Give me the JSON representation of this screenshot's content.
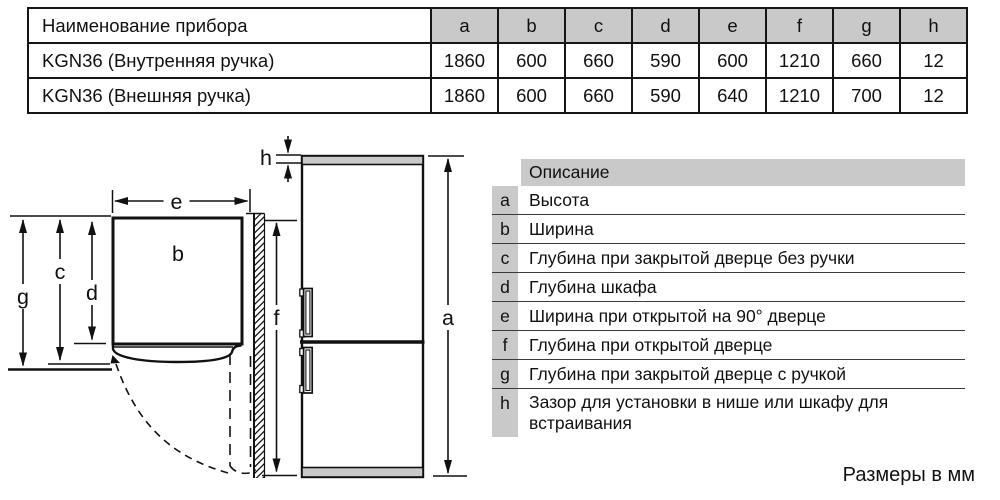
{
  "page": {
    "footer_note": "Размеры в мм"
  },
  "colors": {
    "header_gray": "#c9c9c9",
    "line": "#111111",
    "background": "#ffffff"
  },
  "spec_table": {
    "name_header": "Наименование прибора",
    "dim_headers": [
      "a",
      "b",
      "c",
      "d",
      "e",
      "f",
      "g",
      "h"
    ],
    "rows": [
      {
        "name": "KGN36 (Внутренняя ручка)",
        "values": [
          "1860",
          "600",
          "660",
          "590",
          "600",
          "1210",
          "660",
          "12"
        ]
      },
      {
        "name": "KGN36 (Внешняя ручка)",
        "values": [
          "1860",
          "600",
          "660",
          "590",
          "640",
          "1210",
          "700",
          "12"
        ]
      }
    ]
  },
  "legend": {
    "header": "Описание",
    "rows": [
      {
        "key": "a",
        "text": "Высота"
      },
      {
        "key": "b",
        "text": "Ширина"
      },
      {
        "key": "c",
        "text": "Глубина при закрытой дверце без ручки"
      },
      {
        "key": "d",
        "text": "Глубина шкафа"
      },
      {
        "key": "e",
        "text": "Ширина при открытой на 90° дверце"
      },
      {
        "key": "f",
        "text": "Глубина при открытой дверце"
      },
      {
        "key": "g",
        "text": "Глубина при закрытой дверце с ручкой"
      },
      {
        "key": "h",
        "text": "Зазор для установки в нише или шкафу для встраивания"
      }
    ]
  },
  "diagram": {
    "labels": {
      "a": "a",
      "b": "b",
      "c": "c",
      "d": "d",
      "e": "e",
      "f": "f",
      "g": "g",
      "h": "h"
    }
  }
}
